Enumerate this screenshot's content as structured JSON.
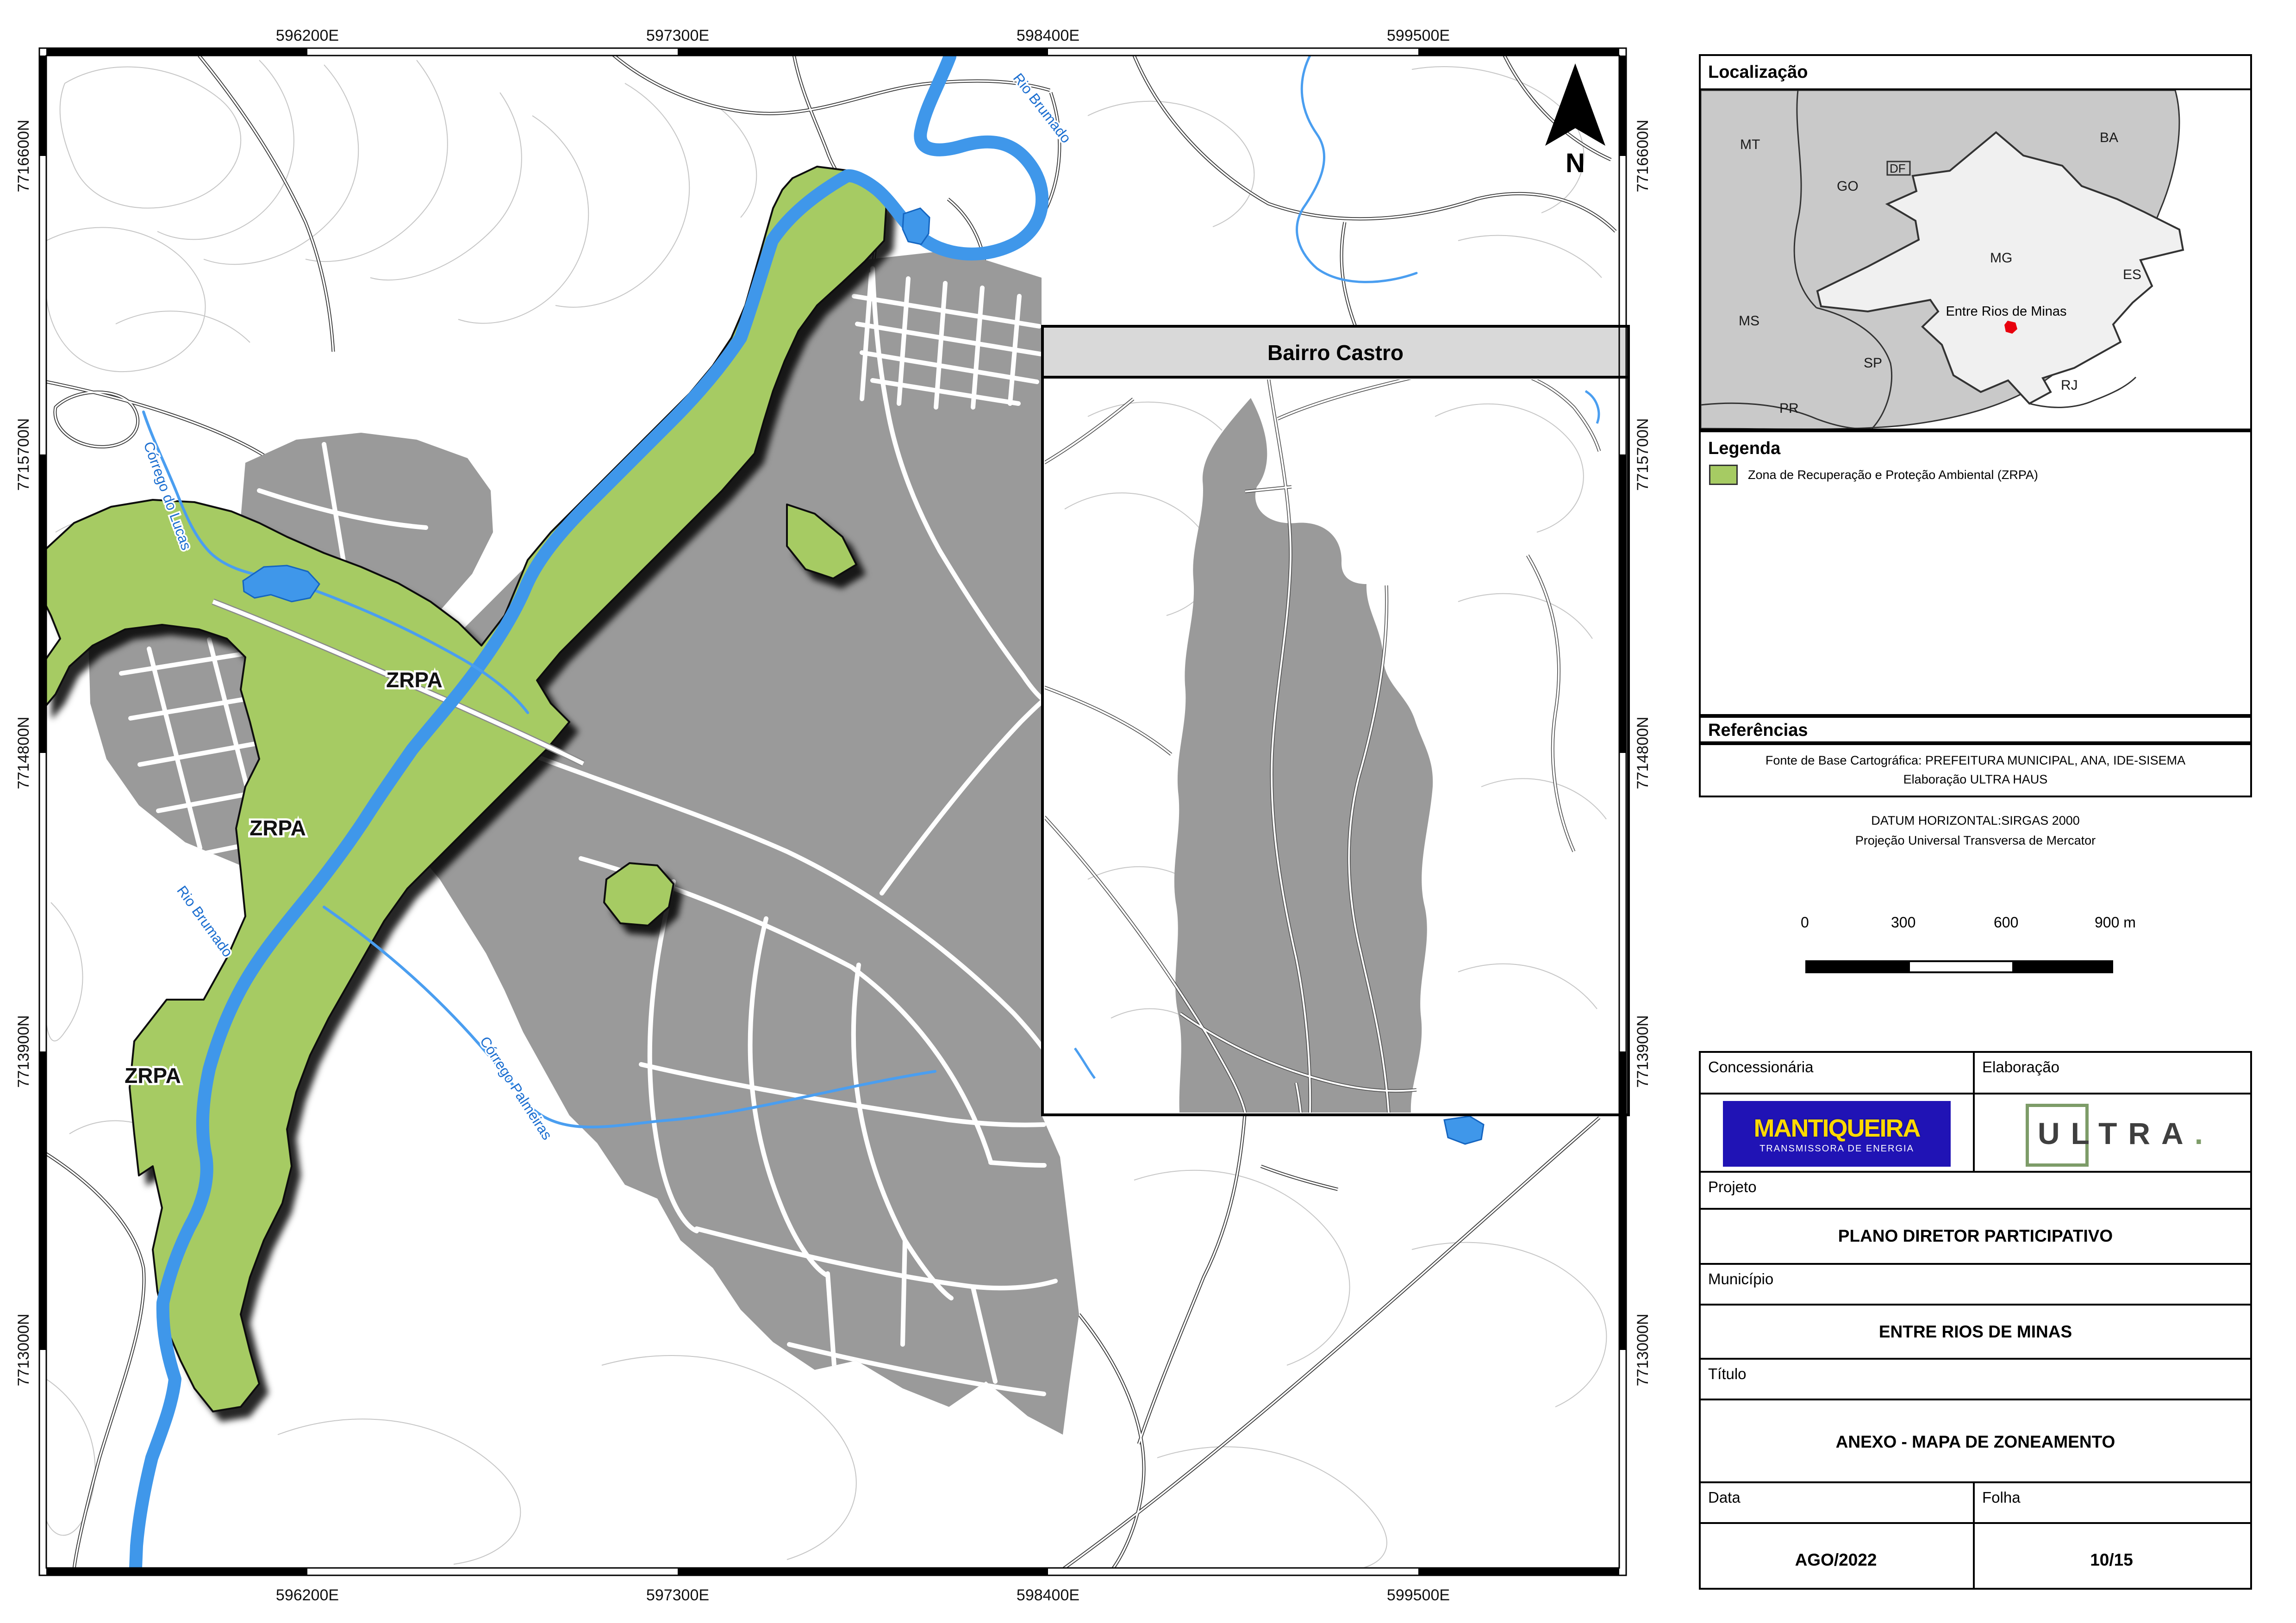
{
  "colors": {
    "zrpa_green": "#a6cb63",
    "river_blue": "#3f97ea",
    "urban_gray": "#9a9a9a",
    "state_gray": "#c9c9c9",
    "mg_fill": "#f0f0f0",
    "marker_red": "#e8000d",
    "logo_blue": "#2013b5",
    "logo_yellow": "#ffd900",
    "inset_titlebar": "#d9d9d9"
  },
  "map": {
    "eastings": [
      "596200E",
      "597300E",
      "598400E",
      "599500E"
    ],
    "northings": [
      "7716600N",
      "7715700N",
      "7714800N",
      "7713900N",
      "7713000N"
    ],
    "north": "N",
    "zrpa": "ZRPA",
    "rivers": {
      "lucas": "Córrego do Lucas",
      "brumado": "Rio Brumado",
      "palmeiras": "Córrego Palmeiras"
    },
    "inset_title": "Bairro Castro"
  },
  "loc": {
    "title": "Localização",
    "states": {
      "MT": "MT",
      "GO": "GO",
      "DF": "DF",
      "BA": "BA",
      "MG": "MG",
      "ES": "ES",
      "MS": "MS",
      "SP": "SP",
      "PR": "PR",
      "RJ": "RJ"
    },
    "marker": "Entre Rios de Minas"
  },
  "legend": {
    "title": "Legenda",
    "item": "Zona de Recuperação e Proteção Ambiental (ZRPA)"
  },
  "refs": {
    "title": "Referências",
    "line1": "Fonte de Base Cartográfica: PREFEITURA MUNICIPAL, ANA, IDE-SISEMA",
    "line2": "Elaboração ULTRA HAUS"
  },
  "datum": {
    "line1": "DATUM HORIZONTAL:SIRGAS 2000",
    "line2": "Projeção Universal Transversa de Mercator"
  },
  "scale": {
    "t0": "0",
    "t1": "300",
    "t2": "600",
    "t3": "900 m"
  },
  "table": {
    "concessionaria": "Concessionária",
    "elaboracao": "Elaboração",
    "logo1_line1": "MANTIQUEIRA",
    "logo1_line2": "TRANSMISSORA DE ENERGIA",
    "logo2": "ULTRA",
    "logo2_dot": ".",
    "projeto": "Projeto",
    "projeto_v": "PLANO DIRETOR PARTICIPATIVO",
    "municipio": "Município",
    "municipio_v": "ENTRE RIOS DE MINAS",
    "titulo": "Título",
    "titulo_v": "ANEXO - MAPA DE ZONEAMENTO",
    "data": "Data",
    "data_v": "AGO/2022",
    "folha": "Folha",
    "folha_v": "10/15"
  }
}
